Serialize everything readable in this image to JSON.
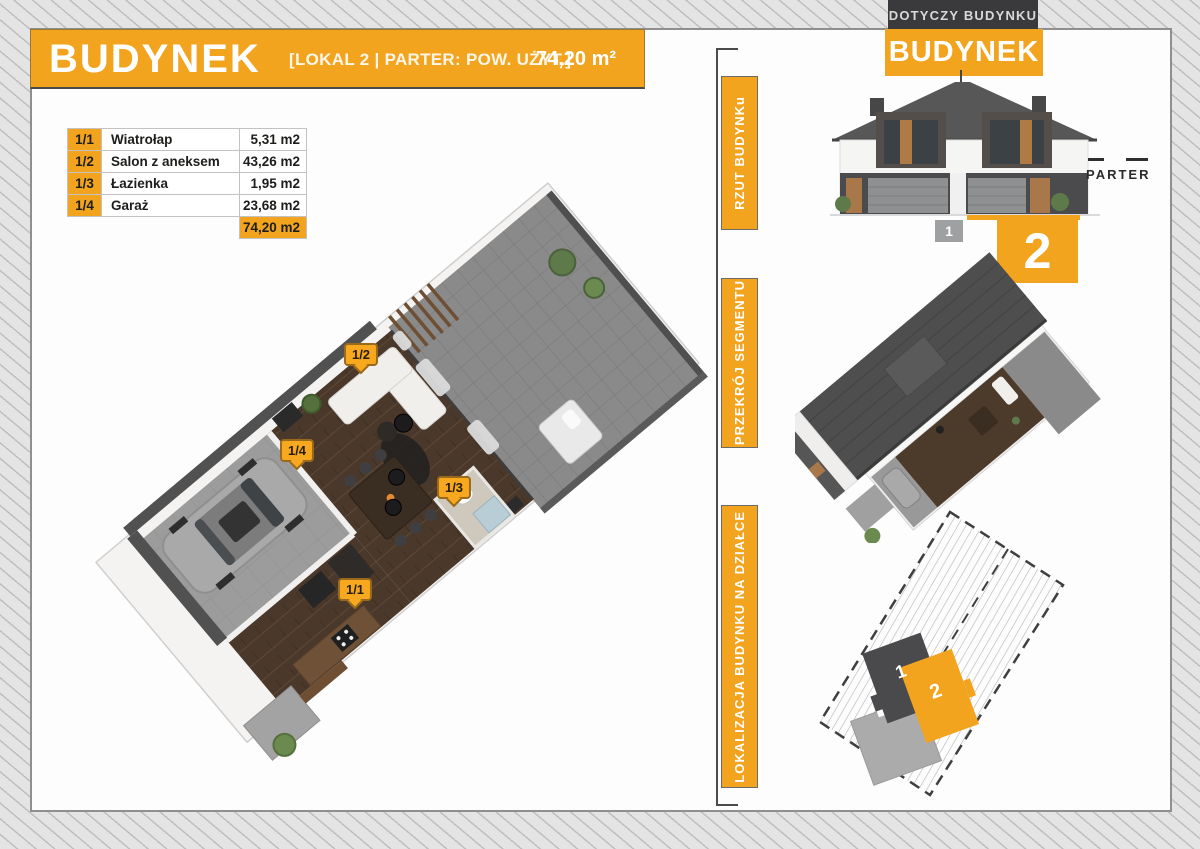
{
  "colors": {
    "accent_orange": "#F2A41F",
    "badge_dark": "#3A3A3C",
    "marker_orange": "#F7A81F"
  },
  "header": {
    "title": "BUDYNEK",
    "subtitle": "[LOKAL 2 | PARTER: POW. UŻYT.]",
    "area": "74,20 m²"
  },
  "rooms_table": {
    "rows": [
      {
        "no": "1/1",
        "name": "Wiatrołap",
        "area": "5,31 m2"
      },
      {
        "no": "1/2",
        "name": "Salon z aneksem",
        "area": "43,26 m2"
      },
      {
        "no": "1/3",
        "name": "Łazienka",
        "area": "1,95 m2"
      },
      {
        "no": "1/4",
        "name": "Garaż",
        "area": "23,68 m2"
      }
    ],
    "total": "74,20 m2"
  },
  "plan_markers": {
    "m11": "1/1",
    "m12": "1/2",
    "m13": "1/3",
    "m14": "1/4"
  },
  "sidebar": {
    "items": [
      {
        "label": "RZUT BUDYNKu"
      },
      {
        "label": "PRZEKRÓJ SEGMENTU"
      },
      {
        "label": "LOKALIZACJA BUDYNKU NA DZIAŁCE"
      }
    ]
  },
  "right_panel": {
    "top_badge": "DOTYCZY BUDYNKU",
    "building_title": "BUDYNEK",
    "floor_label": "PARTER",
    "elevation_unit1": "1",
    "elevation_unit2": "2",
    "site_unit1": "1",
    "site_unit2": "2"
  }
}
